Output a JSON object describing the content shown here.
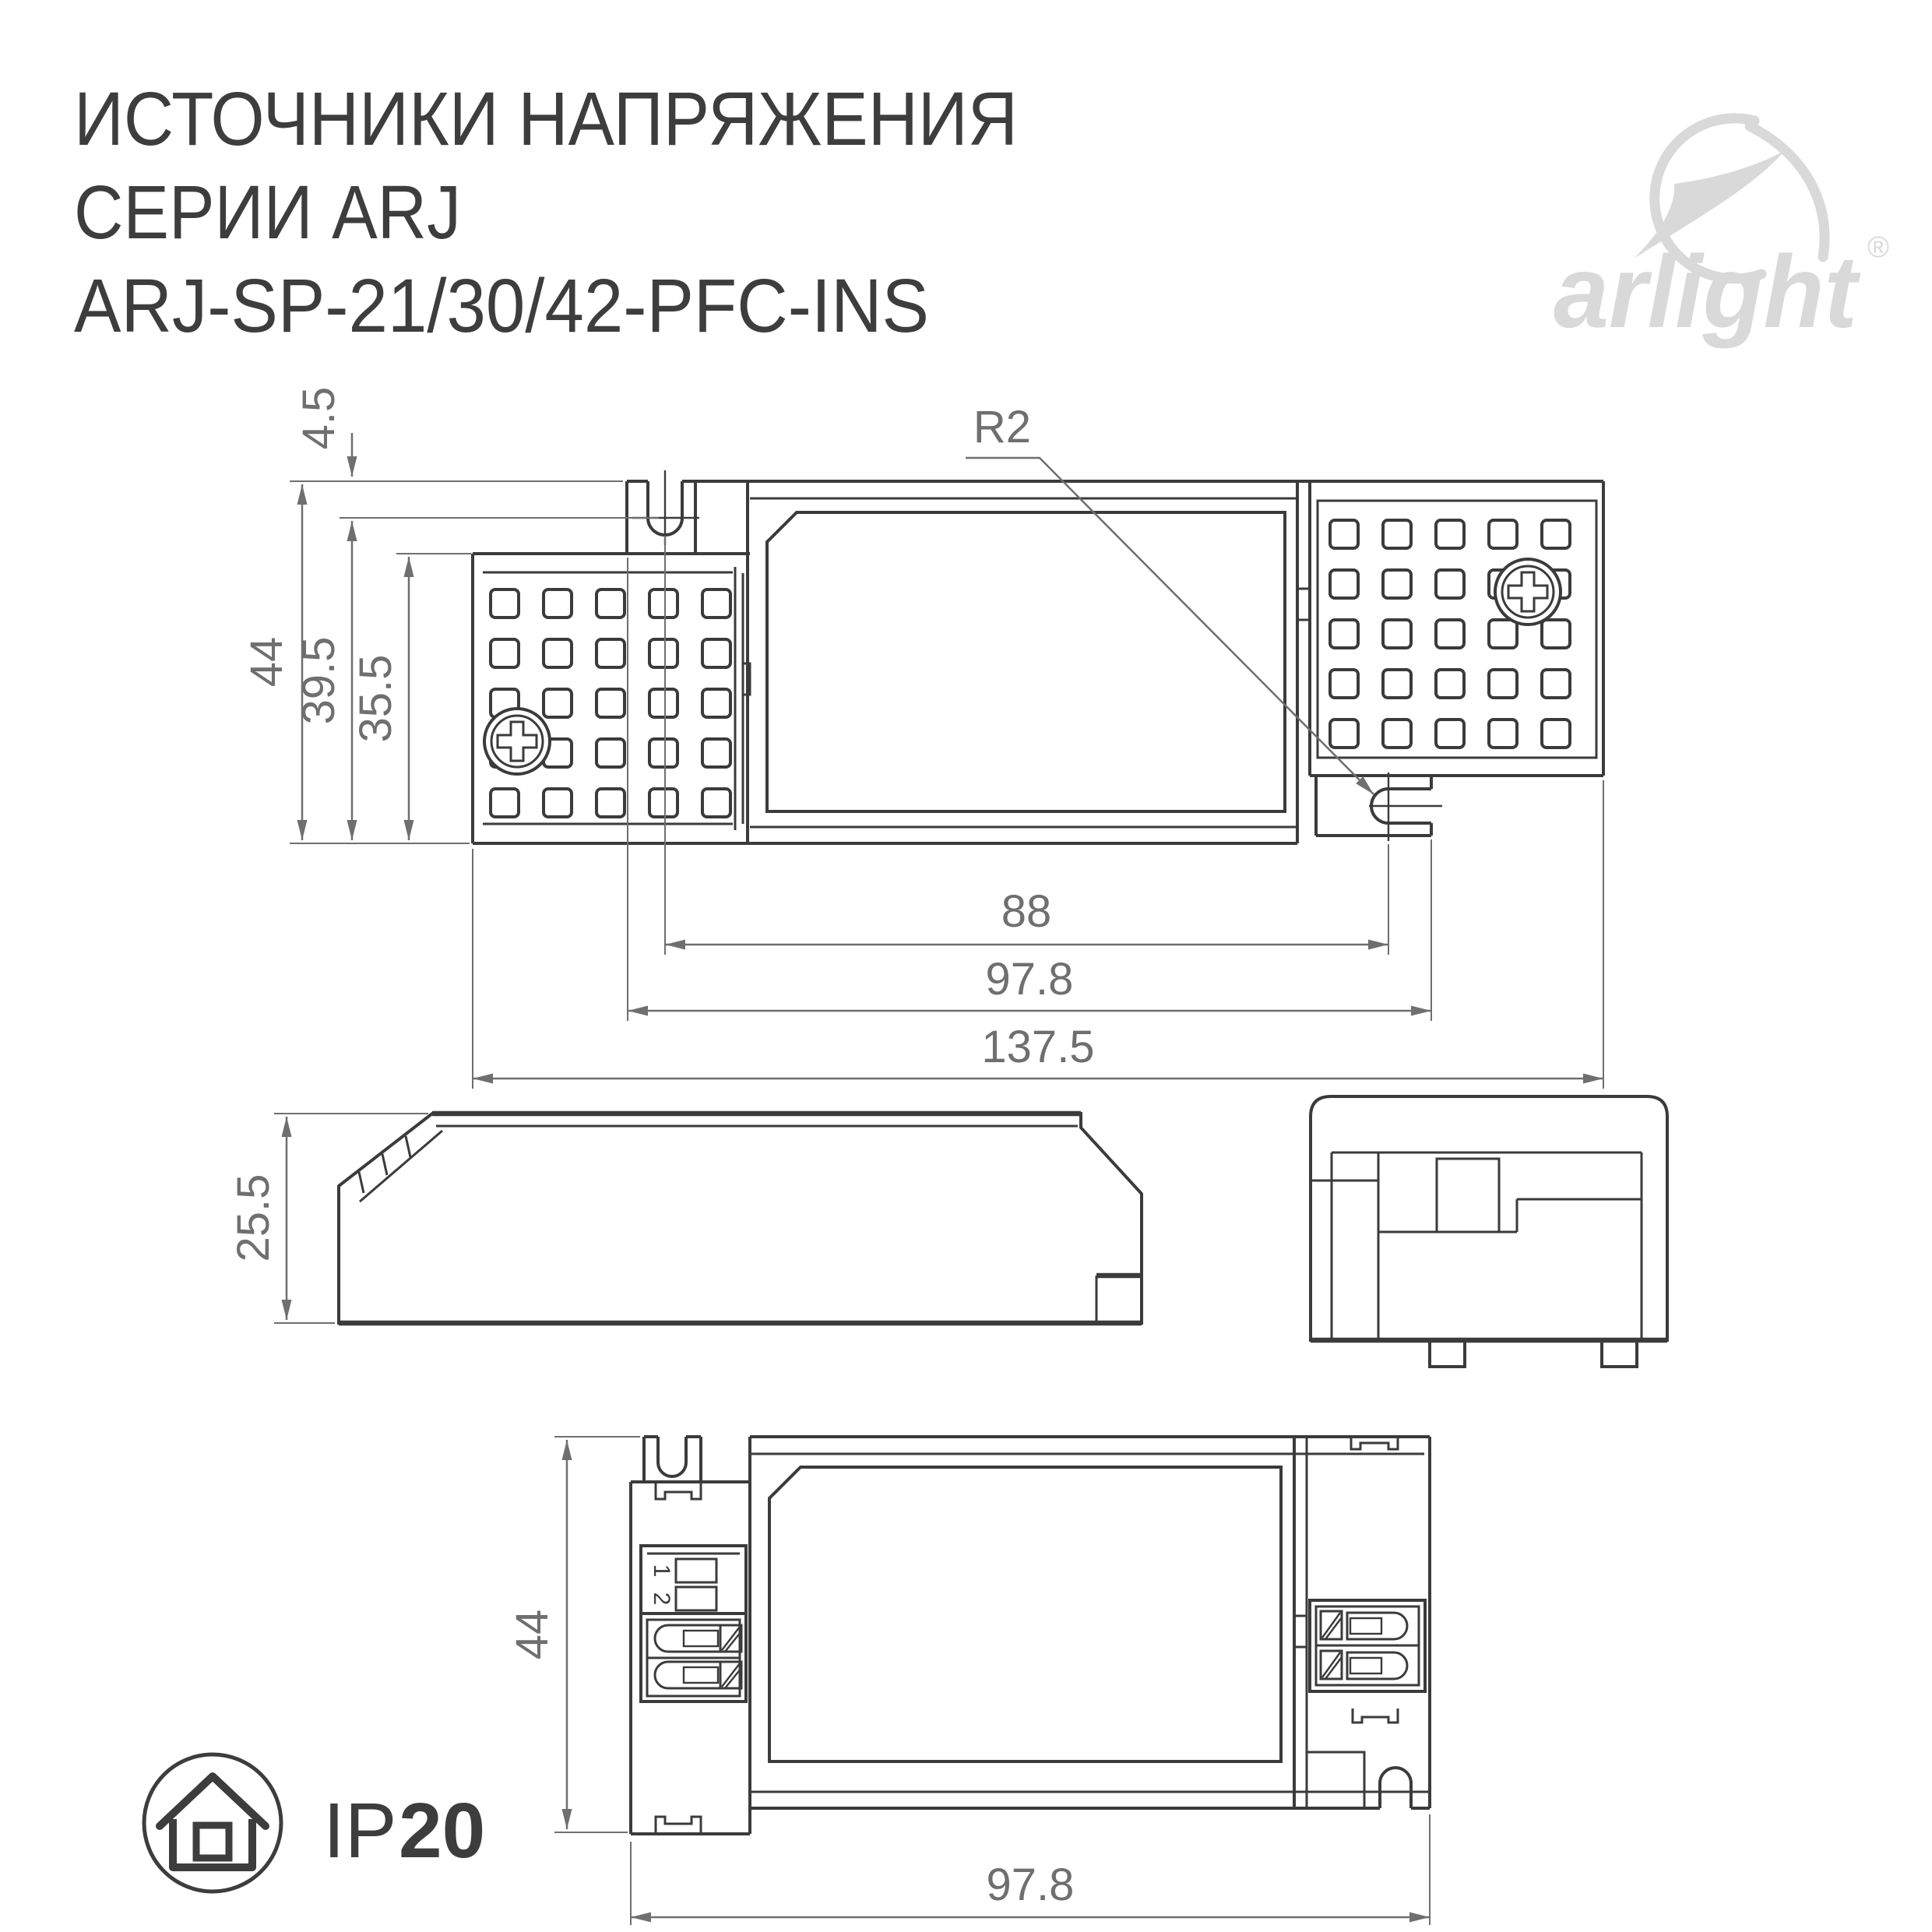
{
  "page": {
    "background": "#ffffff"
  },
  "header": {
    "title_line1": "ИСТОЧНИКИ НАПРЯЖЕНИЯ",
    "title_line2": "СЕРИИ ARJ",
    "title_line3": "ARJ-SP-21/30/42-PFC-INS"
  },
  "logo": {
    "brand": "arlight",
    "registered_mark": "®"
  },
  "ip_rating": {
    "prefix": "IP",
    "value": "20"
  },
  "views": {
    "top_view": {
      "dim_side_offset": "4.5",
      "dim_height_overall": "44",
      "dim_height_body": "39.5",
      "dim_height_vent": "35.5",
      "dim_hole_radius": "R2",
      "dim_hole_spacing": "88",
      "dim_bracket_length": "97.8",
      "dim_length_overall": "137.5"
    },
    "side_view": {
      "dim_height": "25.5"
    },
    "bottom_view": {
      "dim_height": "44",
      "dim_body_length": "97.8",
      "dip_switch_labels": [
        "1",
        "2"
      ]
    }
  },
  "colors": {
    "drawing_line": "#3b3b3b",
    "dimension": "#6f6f6f",
    "title_text": "#3d3d3d",
    "logo": "#d9d9d9"
  }
}
